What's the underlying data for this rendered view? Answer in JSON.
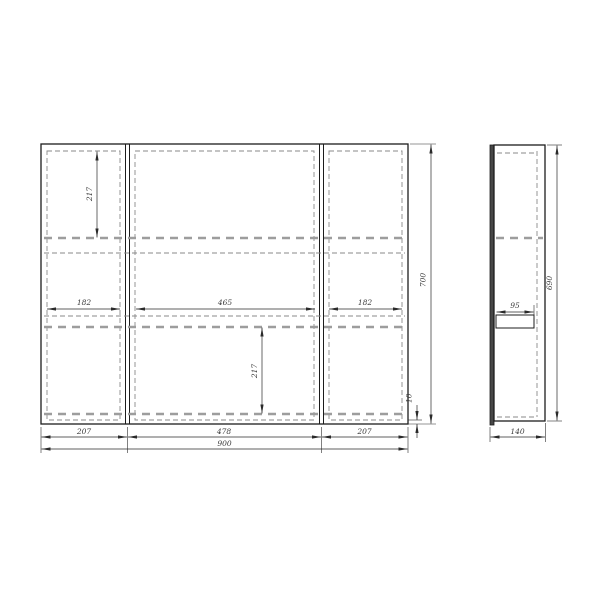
{
  "drawing": {
    "front": {
      "dim_top_section_height": "217",
      "dim_left_shelf_width": "182",
      "dim_center_shelf_width": "465",
      "dim_right_shelf_width": "182",
      "dim_bottom_section_height": "217",
      "dim_bottom_gap": "10",
      "dim_total_height": "700",
      "dim_left_door_width": "207",
      "dim_center_door_width": "478",
      "dim_right_door_width": "207",
      "dim_total_width": "900"
    },
    "side": {
      "dim_shelf_depth": "95",
      "dim_body_height": "690",
      "dim_total_depth": "140"
    }
  }
}
